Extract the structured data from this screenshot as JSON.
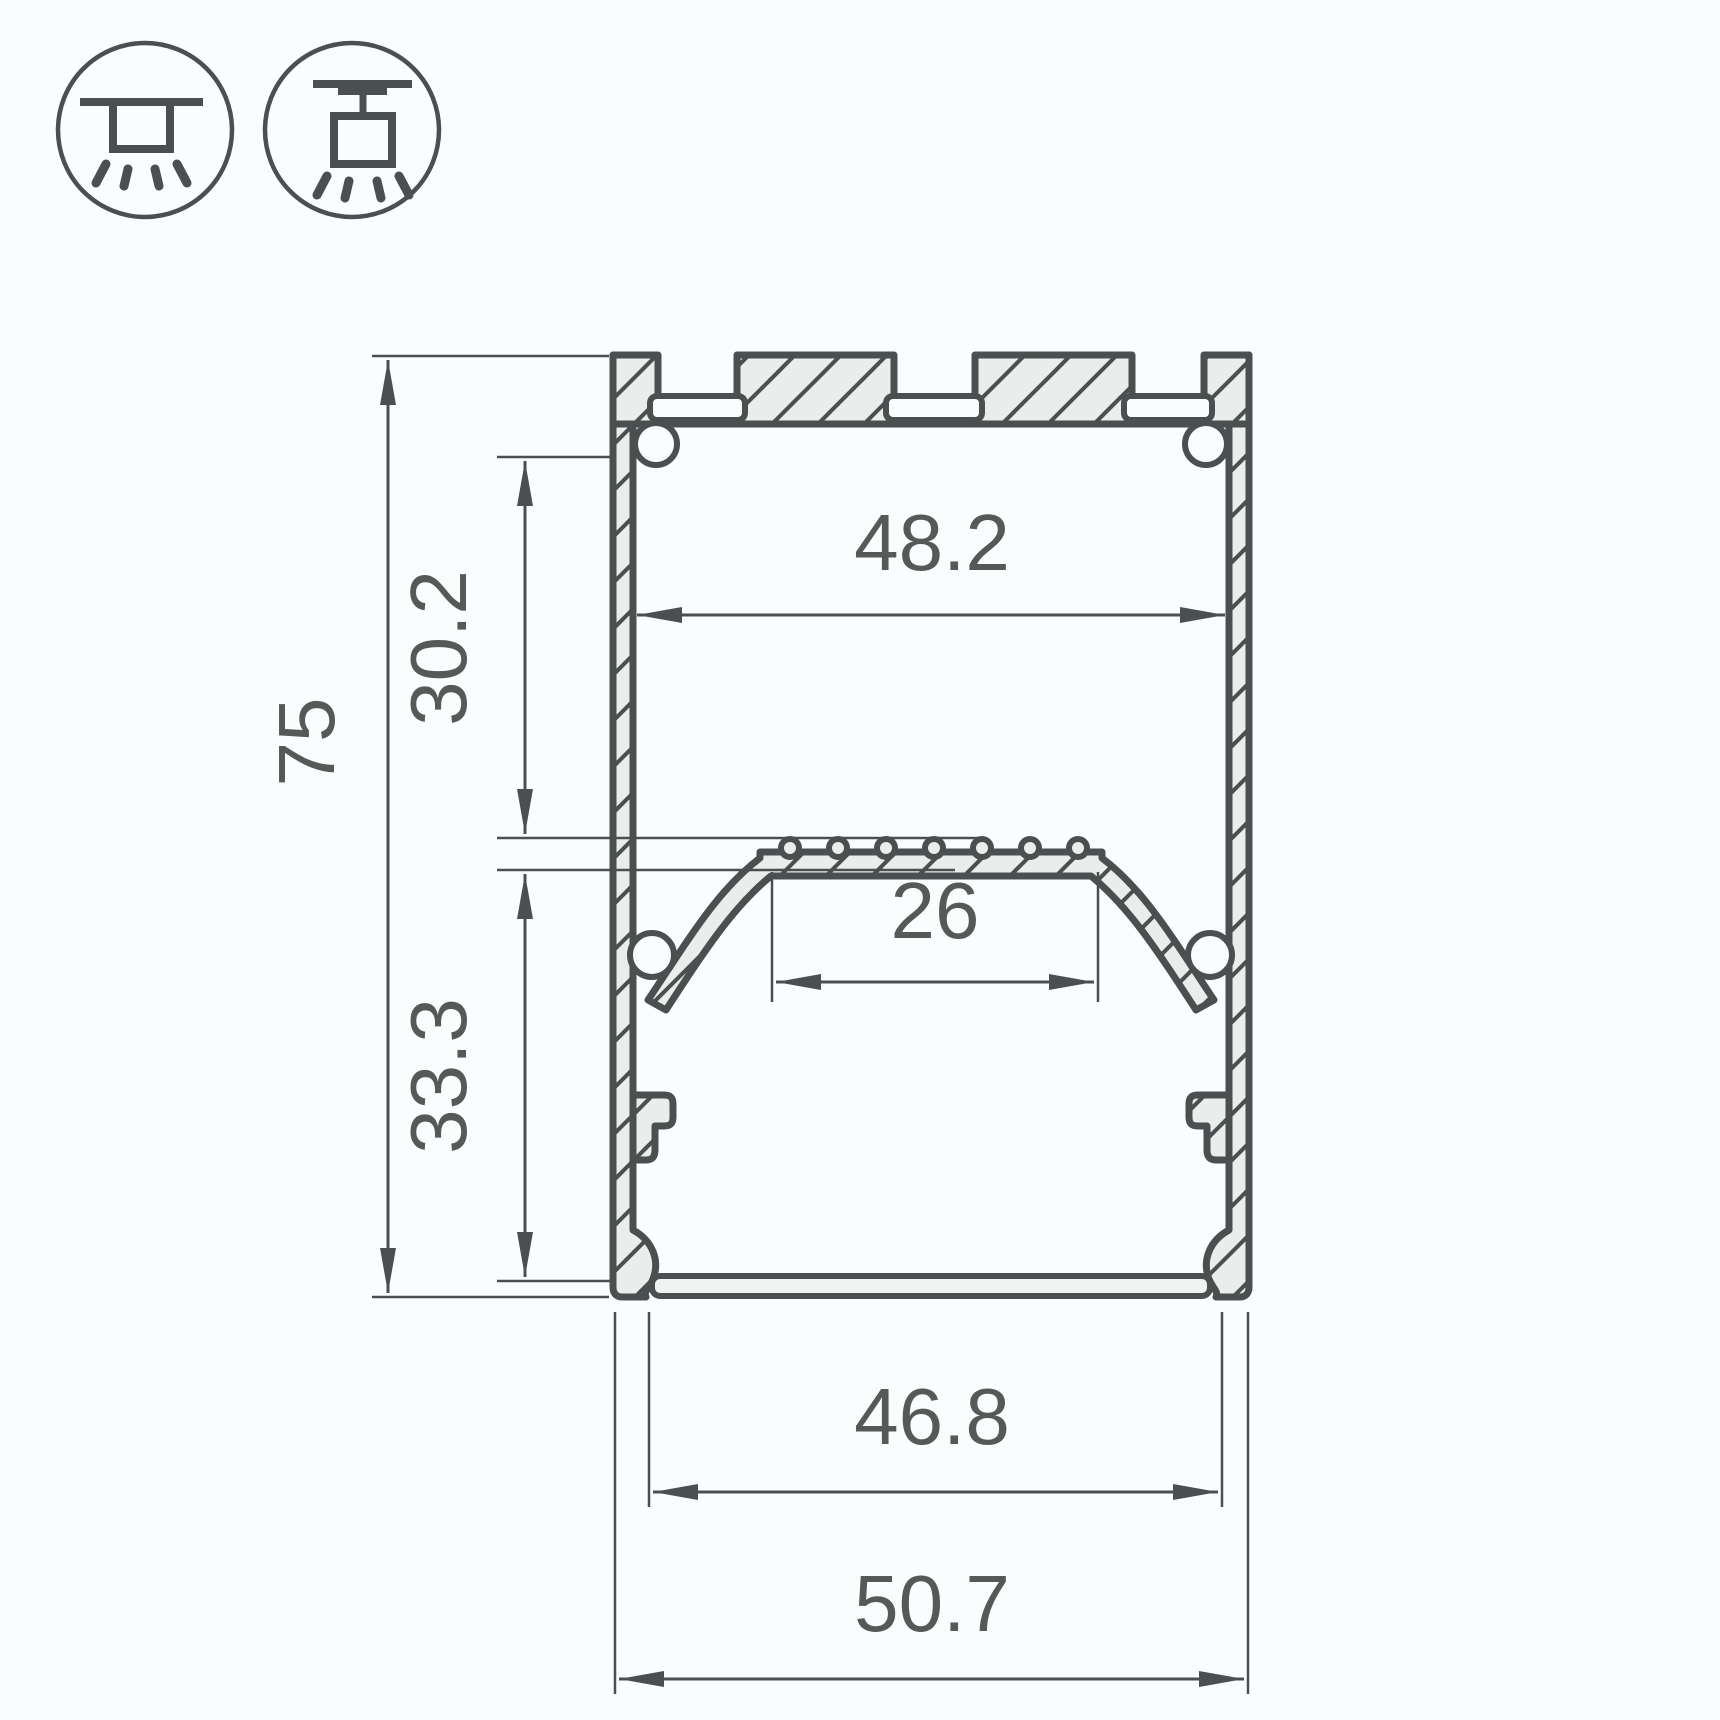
{
  "window": {
    "type": "technical-drawing",
    "subject": "LED aluminium profile cross-section with dimensions"
  },
  "colors": {
    "background": "#fbfcfd",
    "line": "#4a4f4f",
    "metal_fill": "#e9edec",
    "diffuser_fill": "#f1f3f3",
    "text": "#555a59"
  },
  "icons": [
    {
      "name": "surface-mount-luminaire-icon"
    },
    {
      "name": "suspended-luminaire-icon"
    }
  ],
  "dimensions": {
    "overall_height": {
      "value": "75"
    },
    "upper_cavity_height": {
      "value": "30.2"
    },
    "lower_cavity_height": {
      "value": "33.3"
    },
    "inner_width": {
      "value": "48.2"
    },
    "led_strip_width": {
      "value": "26"
    },
    "bottom_inner_width": {
      "value": "46.8"
    },
    "overall_width": {
      "value": "50.7"
    }
  }
}
